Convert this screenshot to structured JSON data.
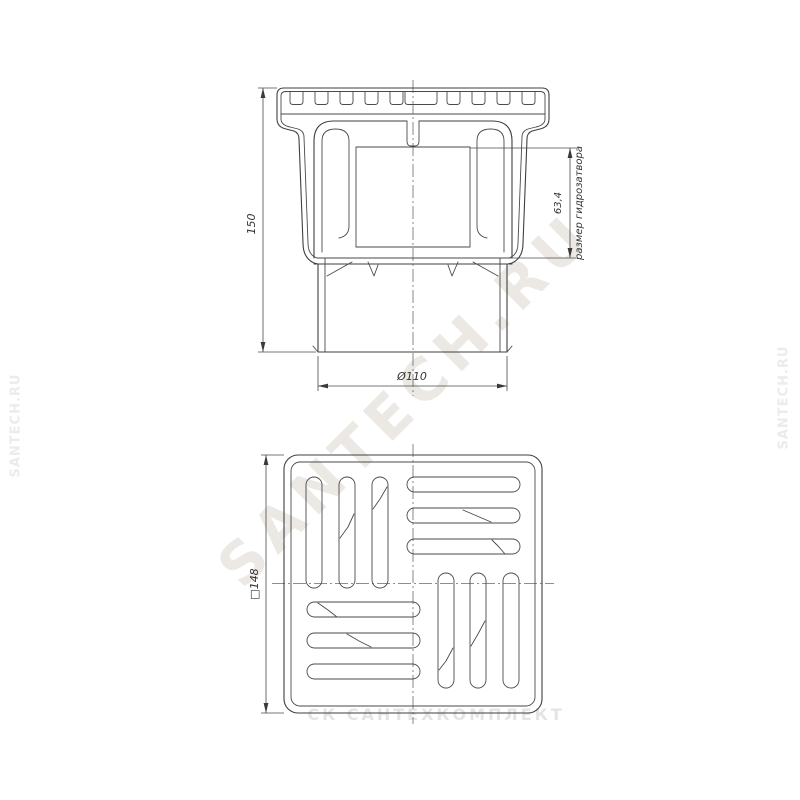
{
  "watermarks": {
    "diagonal": "SANTECH.RU",
    "left_edge": "SANTECH.RU",
    "right_edge": "SANTECH.RU",
    "bottom": "СК САНТЕХКОМПЛЕКТ"
  },
  "side_view": {
    "height_dim": "150",
    "outlet_diameter_dim": "Ø110",
    "water_seal_dim": "63,4",
    "water_seal_label": "размер гидрозатвора"
  },
  "top_view": {
    "grate_size_dim": "□148"
  }
}
